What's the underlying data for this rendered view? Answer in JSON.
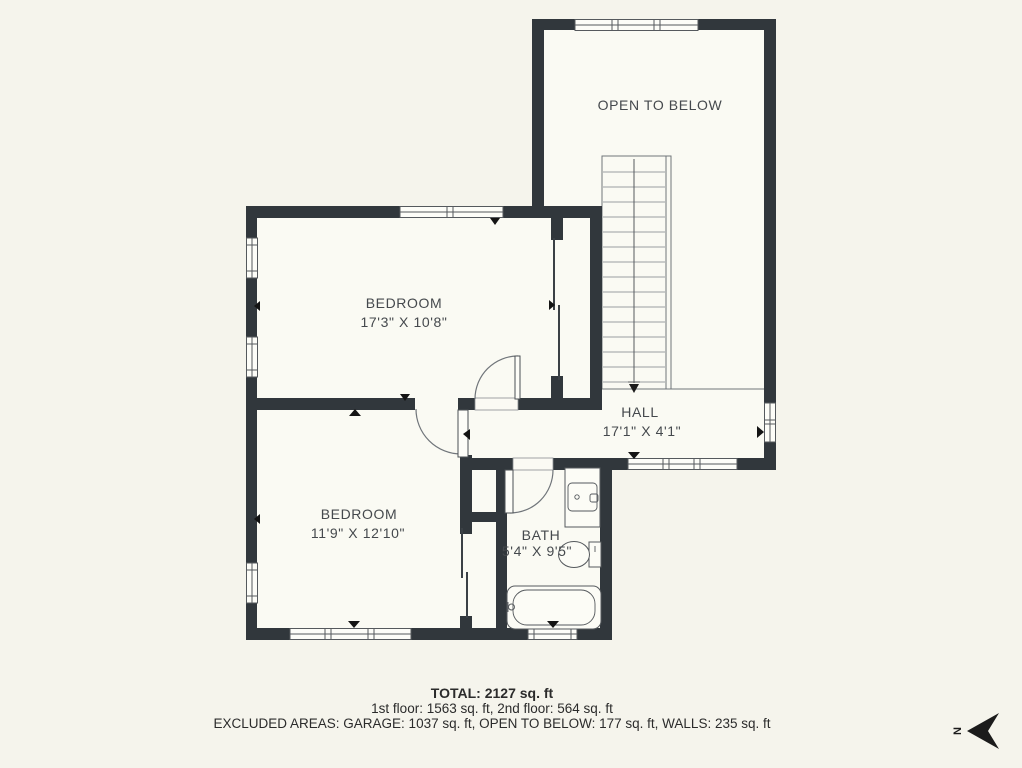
{
  "floorplan": {
    "rooms": [
      {
        "id": "open-to-below",
        "name": "OPEN TO BELOW",
        "dims": ""
      },
      {
        "id": "bedroom-1",
        "name": "BEDROOM",
        "dims": "17'3\" X 10'8\""
      },
      {
        "id": "hall",
        "name": "HALL",
        "dims": "17'1\" X 4'1\""
      },
      {
        "id": "bedroom-2",
        "name": "BEDROOM",
        "dims": "11'9\" X 12'10\""
      },
      {
        "id": "bath",
        "name": "BATH",
        "dims": "5'4\" X 9'5\""
      }
    ],
    "features": [
      "staircase-down",
      "bathtub",
      "toilet",
      "vanity-sink",
      "windows",
      "door-swings",
      "sliding-closet-doors"
    ]
  },
  "summary": {
    "total": "TOTAL: 2127 sq. ft",
    "floors": "1st floor: 1563 sq. ft, 2nd floor: 564 sq. ft",
    "excluded": "EXCLUDED AREAS: GARAGE: 1037 sq. ft, OPEN TO BELOW: 177 sq. ft, WALLS: 235 sq. ft"
  },
  "compass": {
    "label": "N",
    "direction": "north-points-left"
  },
  "colors": {
    "wall": "#31373c",
    "background": "#f5f4ec",
    "floor": "#fafaf3",
    "line": "#70757a",
    "text": "#45494d",
    "summary": "#2b2b2b"
  }
}
